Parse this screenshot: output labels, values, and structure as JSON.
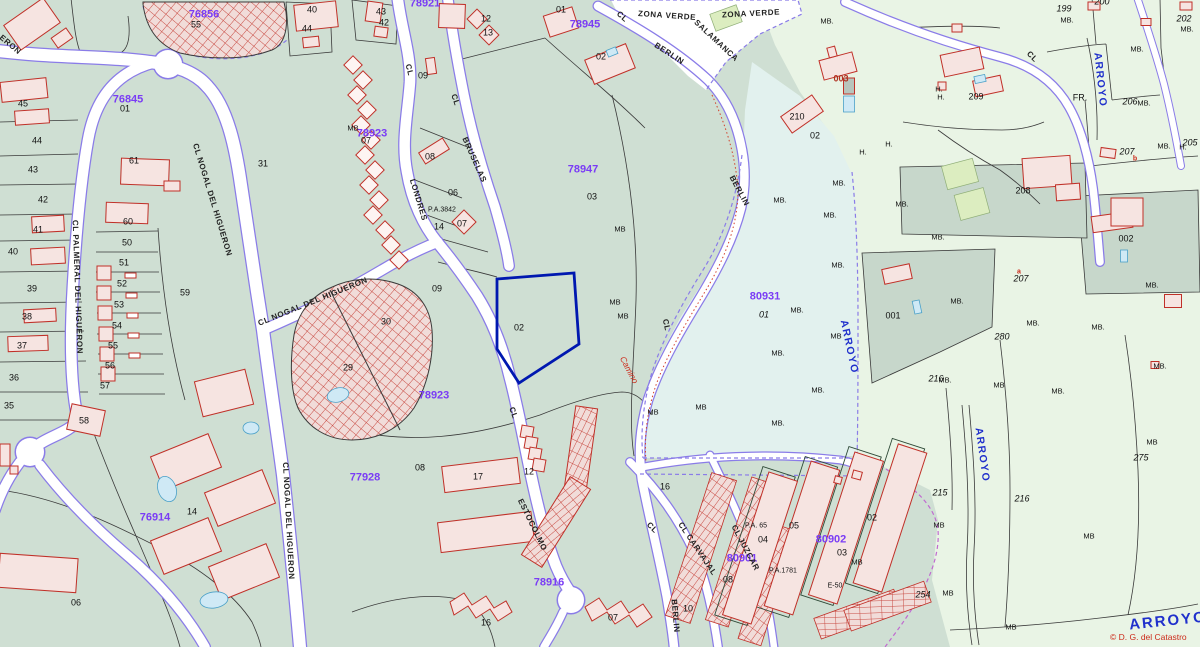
{
  "map": {
    "copyright": "© D. G. del Catastro",
    "colors": {
      "parcel_base": "#cfdfd3",
      "parcel_pale": "#e9f4e5",
      "parcel_gray": "#c7d7cb",
      "parcel_cyan": "#e2f1ee",
      "road_edge": "#8a7ce8",
      "building_outline": "#c03028",
      "building_fill": "#f6e4e1",
      "zone_label": "#7a3cf5",
      "arroyo_label": "#2030cc",
      "selected_parcel_outline": "#0018b0"
    },
    "selected_parcel": {
      "number": "02"
    },
    "labels": [
      {
        "t": "76856",
        "x": 204,
        "y": 15,
        "r": 0,
        "c": "z"
      },
      {
        "t": "76845",
        "x": 128,
        "y": 100,
        "r": 0,
        "c": "z"
      },
      {
        "t": "78921",
        "x": 425,
        "y": 4,
        "r": 0,
        "c": "z"
      },
      {
        "t": "78945",
        "x": 585,
        "y": 25,
        "r": 0,
        "c": "z"
      },
      {
        "t": "78947",
        "x": 583,
        "y": 170,
        "r": 0,
        "c": "z"
      },
      {
        "t": "78923",
        "x": 372,
        "y": 134,
        "r": 0,
        "c": "z"
      },
      {
        "t": "78923",
        "x": 434,
        "y": 396,
        "r": 0,
        "c": "z"
      },
      {
        "t": "77928",
        "x": 365,
        "y": 478,
        "r": 0,
        "c": "z"
      },
      {
        "t": "76914",
        "x": 155,
        "y": 518,
        "r": 0,
        "c": "z"
      },
      {
        "t": "78916",
        "x": 549,
        "y": 583,
        "r": 0,
        "c": "z"
      },
      {
        "t": "80931",
        "x": 765,
        "y": 297,
        "r": 0,
        "c": "z"
      },
      {
        "t": "80902",
        "x": 831,
        "y": 540,
        "r": 0,
        "c": "z"
      },
      {
        "t": "80901",
        "x": 742,
        "y": 559,
        "r": 0,
        "c": "z"
      },
      {
        "t": "ERON",
        "x": 10,
        "y": 45,
        "r": 40,
        "c": "s"
      },
      {
        "t": "CL NOGAL DEL HIGUERON",
        "x": 212,
        "y": 200,
        "r": 73,
        "c": "s"
      },
      {
        "t": "CL NOGAL DEL HIGUERON",
        "x": 313,
        "y": 302,
        "r": -22,
        "c": "s"
      },
      {
        "t": "CL PALMERAL DEL HIGUERON",
        "x": 77,
        "y": 287,
        "r": 88,
        "c": "s"
      },
      {
        "t": "CL NOGAL DEL HIGUERON",
        "x": 288,
        "y": 521,
        "r": 87,
        "c": "s"
      },
      {
        "t": "CL",
        "x": 409,
        "y": 70,
        "r": 75,
        "c": "s"
      },
      {
        "t": "LONDRES",
        "x": 418,
        "y": 200,
        "r": 73,
        "c": "s"
      },
      {
        "t": "CL",
        "x": 455,
        "y": 100,
        "r": 72,
        "c": "s"
      },
      {
        "t": "BRUSELAS",
        "x": 474,
        "y": 160,
        "r": 66,
        "c": "s"
      },
      {
        "t": "CL",
        "x": 513,
        "y": 413,
        "r": 70,
        "c": "s"
      },
      {
        "t": "ESTOCOLMO",
        "x": 532,
        "y": 525,
        "r": 64,
        "c": "s"
      },
      {
        "t": "CL",
        "x": 622,
        "y": 17,
        "r": 42,
        "c": "s"
      },
      {
        "t": "BERLIN",
        "x": 669,
        "y": 54,
        "r": 33,
        "c": "s"
      },
      {
        "t": "BERLIN",
        "x": 739,
        "y": 191,
        "r": 62,
        "c": "s"
      },
      {
        "t": "BERLIN",
        "x": 675,
        "y": 616,
        "r": 85,
        "c": "s"
      },
      {
        "t": "CL",
        "x": 666,
        "y": 325,
        "r": 78,
        "c": "s"
      },
      {
        "t": "CL",
        "x": 652,
        "y": 528,
        "r": 45,
        "c": "s"
      },
      {
        "t": "CL CARVAJAL",
        "x": 697,
        "y": 549,
        "r": 56,
        "c": "s"
      },
      {
        "t": "CL JUZCAR",
        "x": 745,
        "y": 548,
        "r": 62,
        "c": "s"
      },
      {
        "t": "ZONA VERDE",
        "x": 667,
        "y": 16,
        "r": 4,
        "c": "s"
      },
      {
        "t": "SALAMANCA",
        "x": 716,
        "y": 41,
        "r": 43,
        "c": "s"
      },
      {
        "t": "ZONA VERDE",
        "x": 751,
        "y": 14,
        "r": -3,
        "c": "s"
      },
      {
        "t": "CL",
        "x": 1032,
        "y": 57,
        "r": 45,
        "c": "s"
      },
      {
        "t": "ARROYO",
        "x": 1100,
        "y": 80,
        "r": 84,
        "c": "a"
      },
      {
        "t": "ARROYO",
        "x": 849,
        "y": 347,
        "r": 78,
        "c": "a"
      },
      {
        "t": "ARROYO",
        "x": 982,
        "y": 455,
        "r": 82,
        "c": "a"
      },
      {
        "t": "ARROYO",
        "x": 1168,
        "y": 621,
        "r": -6,
        "c": "w"
      },
      {
        "t": "Camino",
        "x": 629,
        "y": 370,
        "r": 62,
        "c": "i"
      },
      {
        "t": "45",
        "x": 23,
        "y": 104,
        "r": 0,
        "c": "p"
      },
      {
        "t": "44",
        "x": 37,
        "y": 141,
        "r": 0,
        "c": "p"
      },
      {
        "t": "43",
        "x": 33,
        "y": 170,
        "r": 0,
        "c": "p"
      },
      {
        "t": "42",
        "x": 43,
        "y": 200,
        "r": 0,
        "c": "p"
      },
      {
        "t": "41",
        "x": 38,
        "y": 230,
        "r": 0,
        "c": "p"
      },
      {
        "t": "40",
        "x": 13,
        "y": 252,
        "r": 0,
        "c": "p"
      },
      {
        "t": "39",
        "x": 32,
        "y": 289,
        "r": 0,
        "c": "p"
      },
      {
        "t": "38",
        "x": 27,
        "y": 317,
        "r": 0,
        "c": "p"
      },
      {
        "t": "37",
        "x": 22,
        "y": 346,
        "r": 0,
        "c": "p"
      },
      {
        "t": "36",
        "x": 14,
        "y": 378,
        "r": 0,
        "c": "p"
      },
      {
        "t": "35",
        "x": 9,
        "y": 406,
        "r": 0,
        "c": "p"
      },
      {
        "t": "61",
        "x": 134,
        "y": 161,
        "r": 0,
        "c": "p"
      },
      {
        "t": "60",
        "x": 128,
        "y": 222,
        "r": 0,
        "c": "p"
      },
      {
        "t": "50",
        "x": 127,
        "y": 243,
        "r": 0,
        "c": "p"
      },
      {
        "t": "51",
        "x": 124,
        "y": 263,
        "r": 0,
        "c": "p"
      },
      {
        "t": "52",
        "x": 122,
        "y": 284,
        "r": 0,
        "c": "p"
      },
      {
        "t": "53",
        "x": 119,
        "y": 305,
        "r": 0,
        "c": "p"
      },
      {
        "t": "54",
        "x": 117,
        "y": 326,
        "r": 0,
        "c": "p"
      },
      {
        "t": "55",
        "x": 113,
        "y": 346,
        "r": 0,
        "c": "p"
      },
      {
        "t": "56",
        "x": 110,
        "y": 366,
        "r": 0,
        "c": "p"
      },
      {
        "t": "57",
        "x": 105,
        "y": 386,
        "r": 0,
        "c": "p"
      },
      {
        "t": "58",
        "x": 84,
        "y": 421,
        "r": 0,
        "c": "p"
      },
      {
        "t": "59",
        "x": 185,
        "y": 293,
        "r": 0,
        "c": "p"
      },
      {
        "t": "55",
        "x": 196,
        "y": 25,
        "r": 0,
        "c": "p"
      },
      {
        "t": "01",
        "x": 125,
        "y": 109,
        "r": 0,
        "c": "p"
      },
      {
        "t": "40",
        "x": 312,
        "y": 10,
        "r": 0,
        "c": "p"
      },
      {
        "t": "44",
        "x": 307,
        "y": 29,
        "r": 0,
        "c": "p"
      },
      {
        "t": "43",
        "x": 381,
        "y": 12,
        "r": 0,
        "c": "p"
      },
      {
        "t": "42",
        "x": 384,
        "y": 23,
        "r": 0,
        "c": "p"
      },
      {
        "t": "12",
        "x": 486,
        "y": 19,
        "r": 0,
        "c": "p"
      },
      {
        "t": "13",
        "x": 488,
        "y": 33,
        "r": 0,
        "c": "p"
      },
      {
        "t": "31",
        "x": 263,
        "y": 164,
        "r": 0,
        "c": "p"
      },
      {
        "t": "01",
        "x": 561,
        "y": 10,
        "r": 0,
        "c": "p"
      },
      {
        "t": "02",
        "x": 601,
        "y": 57,
        "r": 0,
        "c": "p"
      },
      {
        "t": "07",
        "x": 366,
        "y": 141,
        "r": 0,
        "c": "p"
      },
      {
        "t": "09",
        "x": 423,
        "y": 76,
        "r": 0,
        "c": "p"
      },
      {
        "t": "08",
        "x": 430,
        "y": 157,
        "r": 0,
        "c": "p"
      },
      {
        "t": "06",
        "x": 453,
        "y": 193,
        "r": 0,
        "c": "p"
      },
      {
        "t": "P.A.3842",
        "x": 442,
        "y": 210,
        "r": 0,
        "c": "q"
      },
      {
        "t": "14",
        "x": 439,
        "y": 227,
        "r": 0,
        "c": "p"
      },
      {
        "t": "07",
        "x": 462,
        "y": 224,
        "r": 0,
        "c": "p"
      },
      {
        "t": "03",
        "x": 592,
        "y": 197,
        "r": 0,
        "c": "p"
      },
      {
        "t": "02",
        "x": 519,
        "y": 328,
        "r": 0,
        "c": "p"
      },
      {
        "t": "09",
        "x": 437,
        "y": 289,
        "r": 0,
        "c": "p"
      },
      {
        "t": "30",
        "x": 386,
        "y": 322,
        "r": 0,
        "c": "p"
      },
      {
        "t": "29",
        "x": 348,
        "y": 368,
        "r": 0,
        "c": "p"
      },
      {
        "t": "08",
        "x": 420,
        "y": 468,
        "r": 0,
        "c": "p"
      },
      {
        "t": "17",
        "x": 478,
        "y": 477,
        "r": 0,
        "c": "p"
      },
      {
        "t": "12",
        "x": 529,
        "y": 472,
        "r": 0,
        "c": "p"
      },
      {
        "t": "16",
        "x": 486,
        "y": 623,
        "r": 0,
        "c": "p"
      },
      {
        "t": "06",
        "x": 76,
        "y": 603,
        "r": 0,
        "c": "p"
      },
      {
        "t": "14",
        "x": 192,
        "y": 512,
        "r": 0,
        "c": "p"
      },
      {
        "t": "16",
        "x": 665,
        "y": 487,
        "r": 0,
        "c": "p"
      },
      {
        "t": "07",
        "x": 613,
        "y": 618,
        "r": 0,
        "c": "p"
      },
      {
        "t": "10",
        "x": 688,
        "y": 609,
        "r": 0,
        "c": "p"
      },
      {
        "t": "04",
        "x": 763,
        "y": 540,
        "r": 0,
        "c": "p"
      },
      {
        "t": "05",
        "x": 794,
        "y": 526,
        "r": 0,
        "c": "p"
      },
      {
        "t": "02",
        "x": 872,
        "y": 518,
        "r": 0,
        "c": "p"
      },
      {
        "t": "03",
        "x": 842,
        "y": 553,
        "r": 0,
        "c": "p"
      },
      {
        "t": "08",
        "x": 728,
        "y": 580,
        "r": 0,
        "c": "p"
      },
      {
        "t": "P.A. 65",
        "x": 756,
        "y": 526,
        "r": 0,
        "c": "q"
      },
      {
        "t": "P.A.1781",
        "x": 783,
        "y": 571,
        "r": 0,
        "c": "q"
      },
      {
        "t": "E-50",
        "x": 835,
        "y": 586,
        "r": 0,
        "c": "q"
      },
      {
        "t": "215",
        "x": 940,
        "y": 493,
        "r": 0,
        "c": "pi"
      },
      {
        "t": "254",
        "x": 923,
        "y": 595,
        "r": 0,
        "c": "pi"
      },
      {
        "t": "216",
        "x": 1022,
        "y": 499,
        "r": 0,
        "c": "pi"
      },
      {
        "t": "275",
        "x": 1141,
        "y": 458,
        "r": 0,
        "c": "pi"
      },
      {
        "t": "280",
        "x": 1002,
        "y": 337,
        "r": 0,
        "c": "pi"
      },
      {
        "t": "216",
        "x": 936,
        "y": 379,
        "r": 0,
        "c": "pi"
      },
      {
        "t": "001",
        "x": 893,
        "y": 316,
        "r": 0,
        "c": "p"
      },
      {
        "t": "002",
        "x": 1126,
        "y": 239,
        "r": 0,
        "c": "p"
      },
      {
        "t": "199",
        "x": 1064,
        "y": 9,
        "r": 0,
        "c": "pi"
      },
      {
        "t": "200",
        "x": 1102,
        "y": 2,
        "r": 0,
        "c": "pi"
      },
      {
        "t": "202",
        "x": 1184,
        "y": 19,
        "r": 0,
        "c": "pi"
      },
      {
        "t": "209",
        "x": 976,
        "y": 97,
        "r": 0,
        "c": "p"
      },
      {
        "t": "206",
        "x": 1130,
        "y": 102,
        "r": 0,
        "c": "pi"
      },
      {
        "t": "207",
        "x": 1127,
        "y": 152,
        "r": 0,
        "c": "pi"
      },
      {
        "t": "207",
        "x": 1021,
        "y": 279,
        "r": 0,
        "c": "pi"
      },
      {
        "t": "205",
        "x": 1190,
        "y": 143,
        "r": 0,
        "c": "pi"
      },
      {
        "t": "208",
        "x": 1023,
        "y": 191,
        "r": 0,
        "c": "p"
      },
      {
        "t": "210",
        "x": 797,
        "y": 117,
        "r": 0,
        "c": "p"
      },
      {
        "t": "02",
        "x": 815,
        "y": 136,
        "r": 0,
        "c": "p"
      },
      {
        "t": "01",
        "x": 764,
        "y": 315,
        "r": 0,
        "c": "pi"
      },
      {
        "t": "FR.",
        "x": 1080,
        "y": 98,
        "r": 0,
        "c": "p"
      },
      {
        "t": "H.",
        "x": 939,
        "y": 89,
        "r": 0,
        "c": "lpm"
      },
      {
        "t": "H.",
        "x": 941,
        "y": 97,
        "r": 0,
        "c": "lpm"
      },
      {
        "t": "H.",
        "x": 863,
        "y": 152,
        "r": 0,
        "c": "lpm"
      },
      {
        "t": "H.",
        "x": 889,
        "y": 144,
        "r": 0,
        "c": "lpm"
      },
      {
        "t": "H.",
        "x": 1183,
        "y": 147,
        "r": 0,
        "c": "lpm"
      },
      {
        "t": "MB",
        "x": 353,
        "y": 128,
        "r": 0,
        "c": "m"
      },
      {
        "t": "MB",
        "x": 620,
        "y": 229,
        "r": 0,
        "c": "m"
      },
      {
        "t": "MB",
        "x": 653,
        "y": 412,
        "r": 0,
        "c": "m"
      },
      {
        "t": "MB",
        "x": 701,
        "y": 407,
        "r": 0,
        "c": "m"
      },
      {
        "t": "MB",
        "x": 857,
        "y": 562,
        "r": 0,
        "c": "m"
      },
      {
        "t": "MB.",
        "x": 902,
        "y": 204,
        "r": 0,
        "c": "m"
      },
      {
        "t": "MB.",
        "x": 938,
        "y": 237,
        "r": 0,
        "c": "m"
      },
      {
        "t": "MB.",
        "x": 957,
        "y": 301,
        "r": 0,
        "c": "m"
      },
      {
        "t": "MB.",
        "x": 1152,
        "y": 285,
        "r": 0,
        "c": "m"
      },
      {
        "t": "MB.",
        "x": 1033,
        "y": 323,
        "r": 0,
        "c": "m"
      },
      {
        "t": "MB.",
        "x": 1098,
        "y": 327,
        "r": 0,
        "c": "m"
      },
      {
        "t": "MB",
        "x": 999,
        "y": 385,
        "r": 0,
        "c": "m"
      },
      {
        "t": "MB.",
        "x": 1058,
        "y": 391,
        "r": 0,
        "c": "m"
      },
      {
        "t": "MB.",
        "x": 1160,
        "y": 366,
        "r": 0,
        "c": "m"
      },
      {
        "t": "MB.",
        "x": 945,
        "y": 380,
        "r": 0,
        "c": "m"
      },
      {
        "t": "MB.",
        "x": 1067,
        "y": 20,
        "r": 0,
        "c": "m"
      },
      {
        "t": "MB.",
        "x": 1187,
        "y": 29,
        "r": 0,
        "c": "m"
      },
      {
        "t": "MB.",
        "x": 1137,
        "y": 49,
        "r": 0,
        "c": "m"
      },
      {
        "t": "MB.",
        "x": 827,
        "y": 21,
        "r": 0,
        "c": "m"
      },
      {
        "t": "MB.",
        "x": 1144,
        "y": 103,
        "r": 0,
        "c": "m"
      },
      {
        "t": "MB.",
        "x": 1164,
        "y": 146,
        "r": 0,
        "c": "m"
      },
      {
        "t": "MB",
        "x": 939,
        "y": 525,
        "r": 0,
        "c": "m"
      },
      {
        "t": "MB",
        "x": 948,
        "y": 593,
        "r": 0,
        "c": "m"
      },
      {
        "t": "MB",
        "x": 1152,
        "y": 442,
        "r": 0,
        "c": "m"
      },
      {
        "t": "MB",
        "x": 1089,
        "y": 536,
        "r": 0,
        "c": "m"
      },
      {
        "t": "MB",
        "x": 1011,
        "y": 627,
        "r": 0,
        "c": "m"
      },
      {
        "t": "MB.",
        "x": 839,
        "y": 183,
        "r": 0,
        "c": "m"
      },
      {
        "t": "MB.",
        "x": 838,
        "y": 265,
        "r": 0,
        "c": "m"
      },
      {
        "t": "MB.",
        "x": 780,
        "y": 200,
        "r": 0,
        "c": "m"
      },
      {
        "t": "MB.",
        "x": 830,
        "y": 215,
        "r": 0,
        "c": "m"
      },
      {
        "t": "MB",
        "x": 615,
        "y": 302,
        "r": 0,
        "c": "m"
      },
      {
        "t": "MB",
        "x": 623,
        "y": 316,
        "r": 0,
        "c": "m"
      },
      {
        "t": "MB.",
        "x": 797,
        "y": 310,
        "r": 0,
        "c": "m"
      },
      {
        "t": "MB",
        "x": 836,
        "y": 336,
        "r": 0,
        "c": "m"
      },
      {
        "t": "MB.",
        "x": 778,
        "y": 353,
        "r": 0,
        "c": "m"
      },
      {
        "t": "MB.",
        "x": 818,
        "y": 390,
        "r": 0,
        "c": "m"
      },
      {
        "t": "MB.",
        "x": 778,
        "y": 423,
        "r": 0,
        "c": "m"
      },
      {
        "t": "003",
        "x": 841,
        "y": 79,
        "r": 0,
        "c": "r2"
      },
      {
        "t": "a",
        "x": 1019,
        "y": 272,
        "r": 0,
        "c": "r"
      },
      {
        "t": "b",
        "x": 1135,
        "y": 159,
        "r": 0,
        "c": "r"
      }
    ]
  }
}
